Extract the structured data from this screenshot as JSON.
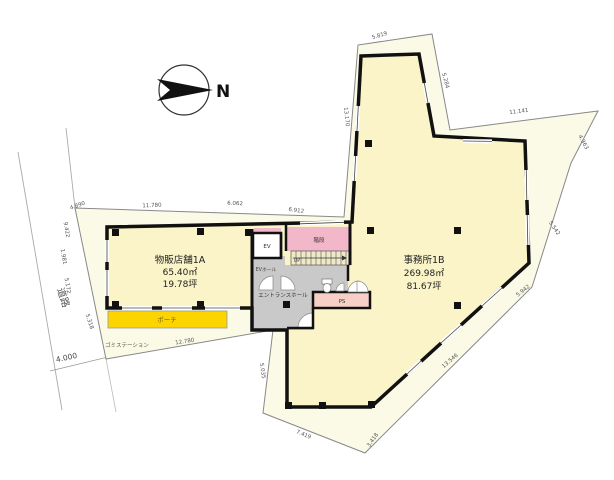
{
  "compass": {
    "label": "N"
  },
  "site": {
    "road_label": "道路",
    "garbage_label": "ゴミステーション"
  },
  "rooms": {
    "retail": {
      "name": "物販店舗1A",
      "area_m2": "65.40㎡",
      "area_tsubo": "19.78坪"
    },
    "office": {
      "name": "事務所1B",
      "area_m2": "269.98㎡",
      "area_tsubo": "81.67坪"
    },
    "ev": "EV",
    "ev_hall": "EVホール",
    "stairs": "階段",
    "up": "UP",
    "entrance_hall": "エントランスホール",
    "ps": "PS",
    "porch": "ポーチ"
  },
  "dimensions": {
    "top1": "11.780",
    "top2": "6.062",
    "top3": "6.912",
    "left1": "4.890",
    "left2": "9.422",
    "left3": "1.981",
    "left4": "5.172",
    "left5": "5.318",
    "road_width": "4.000",
    "bottom1": "12.780",
    "bottom2": "5.035",
    "bottom3": "7.419",
    "bottom4": "3.418",
    "tower_top": "5.819",
    "tower_left": "13.170",
    "tower_right": "5.284",
    "right1": "11.141",
    "right2": "4.363",
    "right3": "5.542",
    "right4": "5.942",
    "right5": "13.546"
  },
  "colors": {
    "site_fill": "#FBFAE6",
    "room_fill": "#FAF4C8",
    "porch_fill": "#FCD400",
    "stairs_fill": "#F2B7C9",
    "ps_fill": "#F8CFC6",
    "hall_fill": "#C9C9C9",
    "wall": "#111111"
  }
}
